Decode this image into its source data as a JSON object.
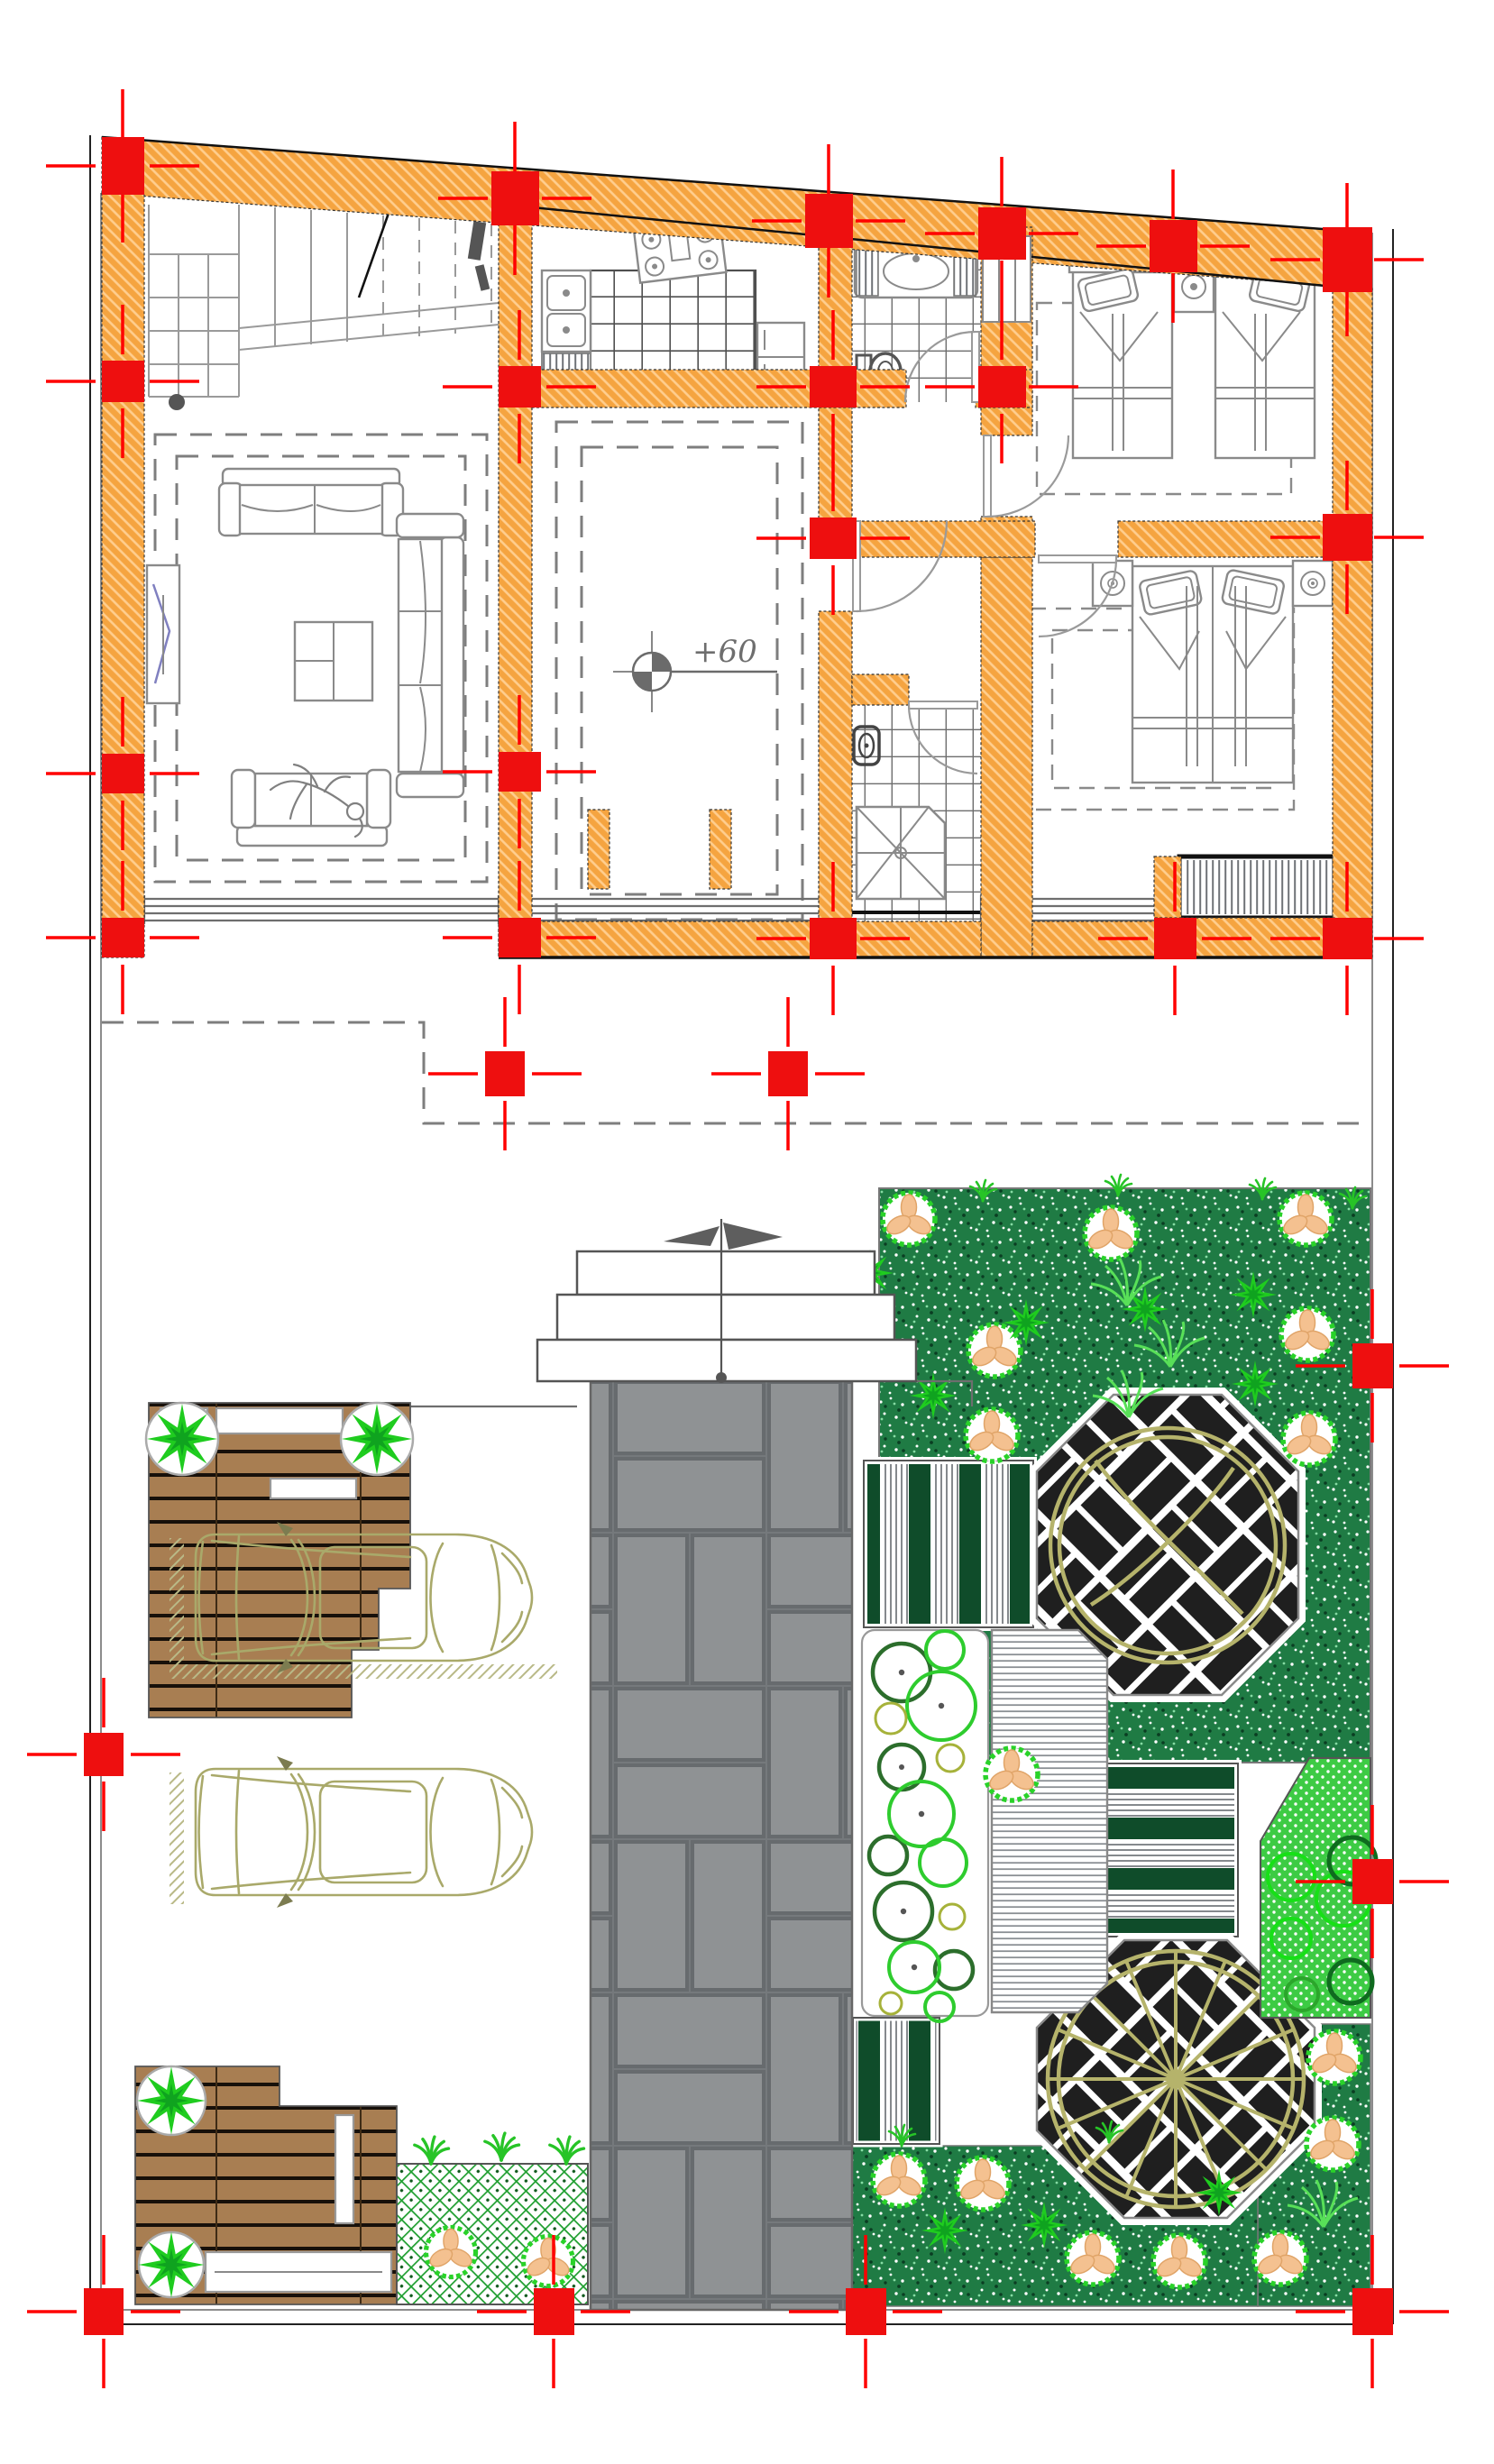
{
  "drawing": {
    "kind": "ground floor plan with landscape site plan",
    "level_label": "+60"
  },
  "colors": {
    "wall_hatch": "#F5A440",
    "column_red": "#EE0F0F",
    "centerline_red": "#FF0000",
    "furniture_gray": "#8A8A8A",
    "ceiling_dash_gray": "#7E7E7E",
    "paver_gray": "#8F9294",
    "deck_brown": "#A87E52",
    "lawn_dark_green": "#1F7B44",
    "hedge_green": "#0F4C2A",
    "bright_green": "#3DCB44",
    "tree_ring_green": "#29D229",
    "tree_petal_peach": "#F4C190",
    "olive": "#A9A96A",
    "lattice_green": "#1E9E2F",
    "paving_black": "#1F1F1F"
  },
  "features": [
    "staircase",
    "kitchen",
    "bathroom",
    "bedroom-twin-beds",
    "living-room",
    "central-hall",
    "wc-shower",
    "bedroom-double-bed",
    "louvre-vent",
    "upper-floor-overhang",
    "entry-steps",
    "paver-walkway",
    "wood-deck-upper",
    "wood-deck-lower",
    "parked-car",
    "parked-car",
    "octagon-paving-circle",
    "octagon-paving-wheel",
    "hedge-bands",
    "shrub-circle-bed",
    "pergola-deck",
    "lattice-planter",
    "lawn",
    "garden-trees"
  ],
  "counts": {
    "cars": 2,
    "octagon_pavings": 2,
    "bedrooms": 2,
    "decks": 2
  }
}
